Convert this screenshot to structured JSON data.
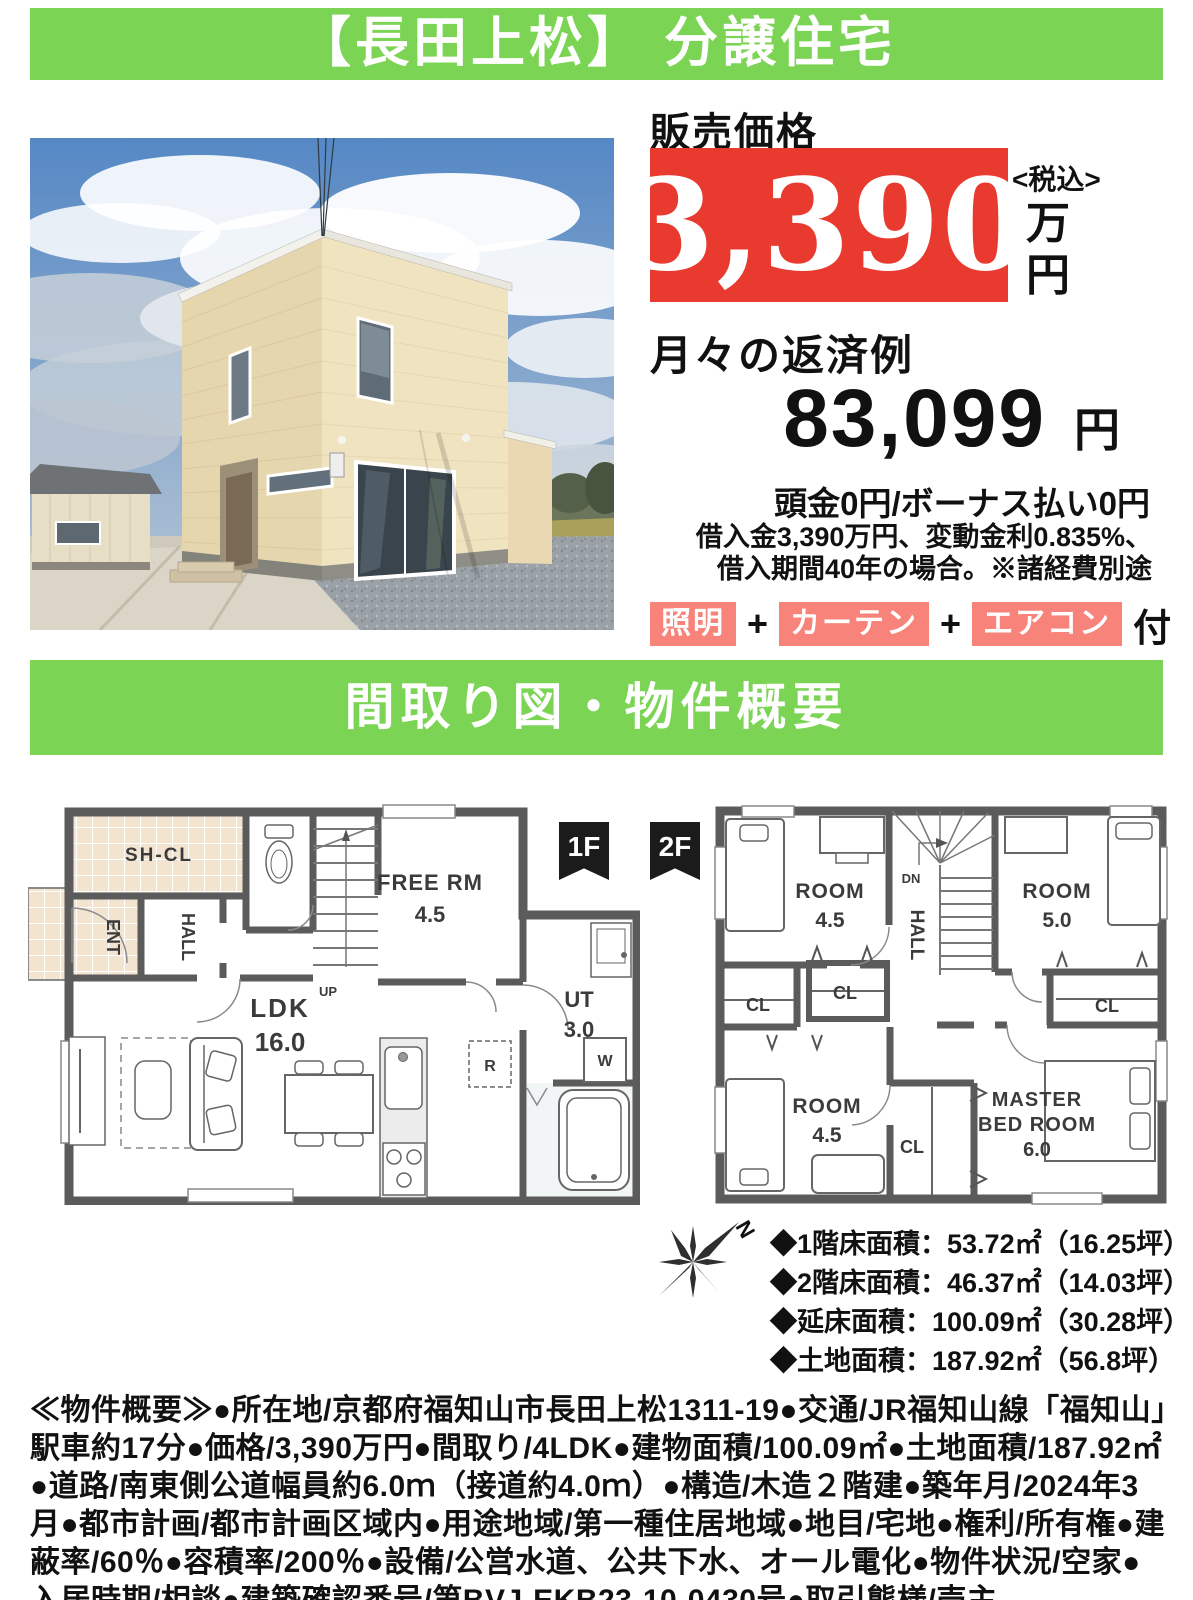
{
  "colors": {
    "green": "#7cd455",
    "red": "#e93a30",
    "salmon": "#f8837a",
    "wall_gray": "#5b5b5b"
  },
  "banner1": {
    "title": "【長田上松】 分譲住宅"
  },
  "price": {
    "label": "販売価格",
    "amount": "3,390",
    "tax_note": "<税込>",
    "unit1": "万",
    "unit2": "円"
  },
  "payment": {
    "title": "月々の返済例",
    "amount": "83,099",
    "unit": "円",
    "down": "頭金0円/ボーナス払い0円",
    "note1": "借入金3,390万円、変動金利0.835%、",
    "note2": "借入期間40年の場合。※諸経費別途"
  },
  "equipment": {
    "item1": "照明",
    "item2": "カーテン",
    "item3": "エアコン",
    "plus": "+",
    "suffix": "付"
  },
  "banner2": {
    "title": "間取り図・物件概要"
  },
  "plan": {
    "f1_tag": "1F",
    "f2_tag": "2F",
    "compass_n": "N",
    "f1": {
      "shcl": "SH-CL",
      "ent": "ENT",
      "hall": "HALL",
      "up": "UP",
      "free": "FREE RM",
      "free_size": "4.5",
      "ldk": "LDK",
      "ldk_size": "16.0",
      "ut": "UT",
      "ut_size": "3.0",
      "fridge": "R",
      "wash": "W"
    },
    "f2": {
      "dn": "DN",
      "hall": "HALL",
      "room_a": "ROOM",
      "room_a_size": "4.5",
      "room_b": "ROOM",
      "room_b_size": "5.0",
      "room_c": "ROOM",
      "room_c_size": "4.5",
      "cl1": "CL",
      "cl2": "CL",
      "cl3": "CL",
      "cl4": "CL",
      "master1": "MASTER",
      "master2": "BED ROOM",
      "master_size": "6.0"
    }
  },
  "areas": {
    "line1": "◆1階床面積：53.72㎡（16.25坪）",
    "line2": "◆2階床面積：46.37㎡（14.03坪）",
    "line3": "◆延床面積：100.09㎡（30.28坪）",
    "line4": "◆土地面積：187.92㎡（56.8坪）"
  },
  "overview": {
    "text": "≪物件概要≫●所在地/京都府福知山市長田上松1311-19●交通/JR福知山線「福知山」駅車約17分●価格/3,390万円●間取り/4LDK●建物面積/100.09㎡●土地面積/187.92㎡●道路/南東側公道幅員約6.0ｍ（接道約4.0ｍ）●構造/木造２階建●築年月/2024年3月●都市計画/都市計画区域内●用途地域/第一種住居地域●地目/宅地●権利/所有権●建蔽率/60％●容積率/200％●設備/公営水道、公共下水、オール電化●物件状況/空家●入居時期/相談●建築確認番号/第BVJ-EKB23-10-0430号●取引態様/売主"
  }
}
